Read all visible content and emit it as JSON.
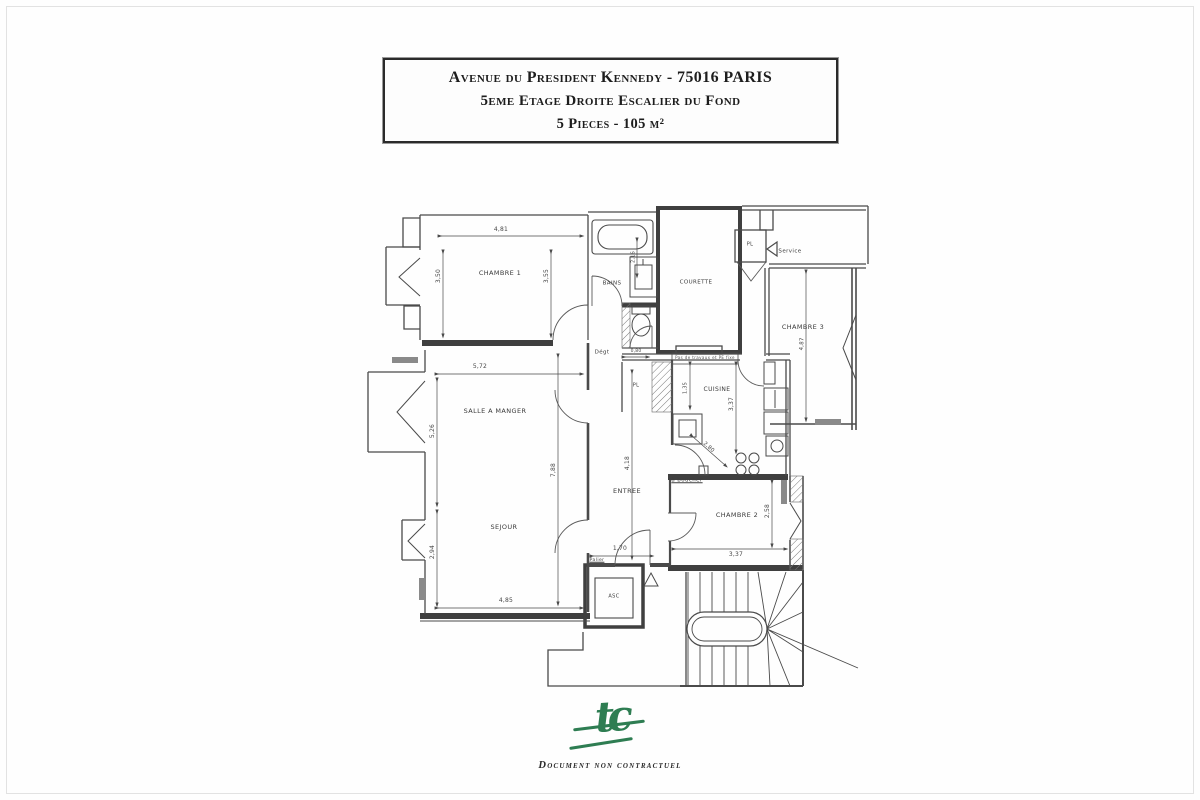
{
  "title_block": {
    "line1": "Avenue du President Kennedy - 75016 PARIS",
    "line2": "5eme Etage Droite Escalier du Fond",
    "line3": "5 Pieces - 105 m²"
  },
  "footer": {
    "logo": "tc",
    "disclaimer": "Document non contractuel"
  },
  "colors": {
    "line": "#4a4a4a",
    "logo_green": "#2e7d52",
    "text": "#333333"
  },
  "plan": {
    "labels": [
      {
        "name": "room-label-chambre-1",
        "text": "CHAMBRE 1",
        "x": 500,
        "y": 273,
        "size": 6.5,
        "cls": "room"
      },
      {
        "name": "room-label-bains",
        "text": "BAINS",
        "x": 612,
        "y": 284,
        "size": 5.5,
        "cls": "room"
      },
      {
        "name": "room-label-courette",
        "text": "COURETTE",
        "x": 696,
        "y": 283,
        "size": 5.5,
        "cls": "room"
      },
      {
        "name": "room-label-pl-service",
        "text": "PL",
        "x": 750,
        "y": 245,
        "size": 5,
        "cls": "room"
      },
      {
        "name": "room-label-service",
        "text": "Service",
        "x": 790,
        "y": 252,
        "size": 5.5,
        "cls": "room"
      },
      {
        "name": "room-label-chambre-3",
        "text": "CHAMBRE 3",
        "x": 803,
        "y": 327,
        "size": 6.5,
        "cls": "room"
      },
      {
        "name": "room-label-degagement",
        "text": "Dégt",
        "x": 602,
        "y": 353,
        "size": 5.5,
        "cls": "room"
      },
      {
        "name": "room-label-salle-a-manger",
        "text": "SALLE A MANGER",
        "x": 495,
        "y": 411,
        "size": 6.5,
        "cls": "room"
      },
      {
        "name": "room-label-cuisine",
        "text": "CUISINE",
        "x": 717,
        "y": 390,
        "size": 6,
        "cls": "room"
      },
      {
        "name": "room-label-pl-cuisine",
        "text": "PL",
        "x": 636,
        "y": 386,
        "size": 5,
        "cls": "room"
      },
      {
        "name": "room-label-entree",
        "text": "ENTREE",
        "x": 627,
        "y": 491,
        "size": 6.5,
        "cls": "room"
      },
      {
        "name": "room-label-sejour",
        "text": "SEJOUR",
        "x": 504,
        "y": 527,
        "size": 6.5,
        "cls": "room"
      },
      {
        "name": "room-label-chambre-2",
        "text": "CHAMBRE 2",
        "x": 737,
        "y": 515,
        "size": 6.5,
        "cls": "room"
      },
      {
        "name": "room-label-asc",
        "text": "ASC",
        "x": 614,
        "y": 597,
        "size": 5,
        "cls": "room"
      },
      {
        "name": "dim-4-81",
        "text": "4,81",
        "x": 501,
        "y": 230,
        "size": 6,
        "cls": "dim"
      },
      {
        "name": "dim-3-50",
        "text": "3,50",
        "x": 439,
        "y": 276,
        "rot": -90,
        "size": 6,
        "cls": "dim"
      },
      {
        "name": "dim-3-55",
        "text": "3,55",
        "x": 547,
        "y": 276,
        "rot": -90,
        "size": 6,
        "cls": "dim"
      },
      {
        "name": "dim-2-16",
        "text": "2,16",
        "x": 634,
        "y": 257,
        "rot": -90,
        "size": 5,
        "cls": "dim"
      },
      {
        "name": "dim-5-72",
        "text": "5,72",
        "x": 480,
        "y": 367,
        "size": 6,
        "cls": "dim"
      },
      {
        "name": "dim-5-26",
        "text": "5,26",
        "x": 433,
        "y": 431,
        "rot": -90,
        "size": 6,
        "cls": "dim"
      },
      {
        "name": "dim-2-94",
        "text": "2,94",
        "x": 433,
        "y": 552,
        "rot": -90,
        "size": 6,
        "cls": "dim"
      },
      {
        "name": "dim-7-88",
        "text": "7,88",
        "x": 554,
        "y": 470,
        "rot": -90,
        "size": 6,
        "cls": "dim"
      },
      {
        "name": "dim-4-85",
        "text": "4,85",
        "x": 506,
        "y": 601,
        "size": 6,
        "cls": "dim"
      },
      {
        "name": "dim-4-18",
        "text": "4,18",
        "x": 628,
        "y": 463,
        "rot": -90,
        "size": 6,
        "cls": "dim"
      },
      {
        "name": "dim-1-70",
        "text": "1,70",
        "x": 620,
        "y": 549,
        "size": 6,
        "cls": "dim"
      },
      {
        "name": "dim-0-80",
        "text": "0,80",
        "x": 636,
        "y": 352,
        "size": 4.5,
        "cls": "dim"
      },
      {
        "name": "dim-1-35",
        "text": "1,35",
        "x": 686,
        "y": 388,
        "rot": -90,
        "size": 5,
        "cls": "dim"
      },
      {
        "name": "dim-3-37-cuisine",
        "text": "3,37",
        "x": 732,
        "y": 404,
        "rot": -90,
        "size": 6,
        "cls": "dim"
      },
      {
        "name": "dim-2-80",
        "text": "2,80",
        "x": 708,
        "y": 448,
        "rot": 42,
        "size": 5.5,
        "cls": "dim"
      },
      {
        "name": "dim-3-37-chambre2",
        "text": "3,37",
        "x": 736,
        "y": 555,
        "size": 6,
        "cls": "dim"
      },
      {
        "name": "dim-2-58",
        "text": "2,58",
        "x": 768,
        "y": 511,
        "rot": -90,
        "size": 6,
        "cls": "dim"
      },
      {
        "name": "dim-4-87",
        "text": "4,87",
        "x": 803,
        "y": 344,
        "rot": -87,
        "size": 5.5,
        "cls": "dim"
      },
      {
        "name": "annotation-a-boucher",
        "text": "à boucher",
        "x": 687,
        "y": 481,
        "size": 5.5,
        "cls": "underline"
      },
      {
        "name": "annotation-courette-note",
        "text": "Pas de travaux et PE fixe",
        "x": 705,
        "y": 358,
        "size": 4,
        "cls": "boxed"
      },
      {
        "name": "annotation-palier",
        "text": "Palier",
        "x": 597,
        "y": 561,
        "size": 4.5,
        "cls": "underline"
      }
    ]
  }
}
